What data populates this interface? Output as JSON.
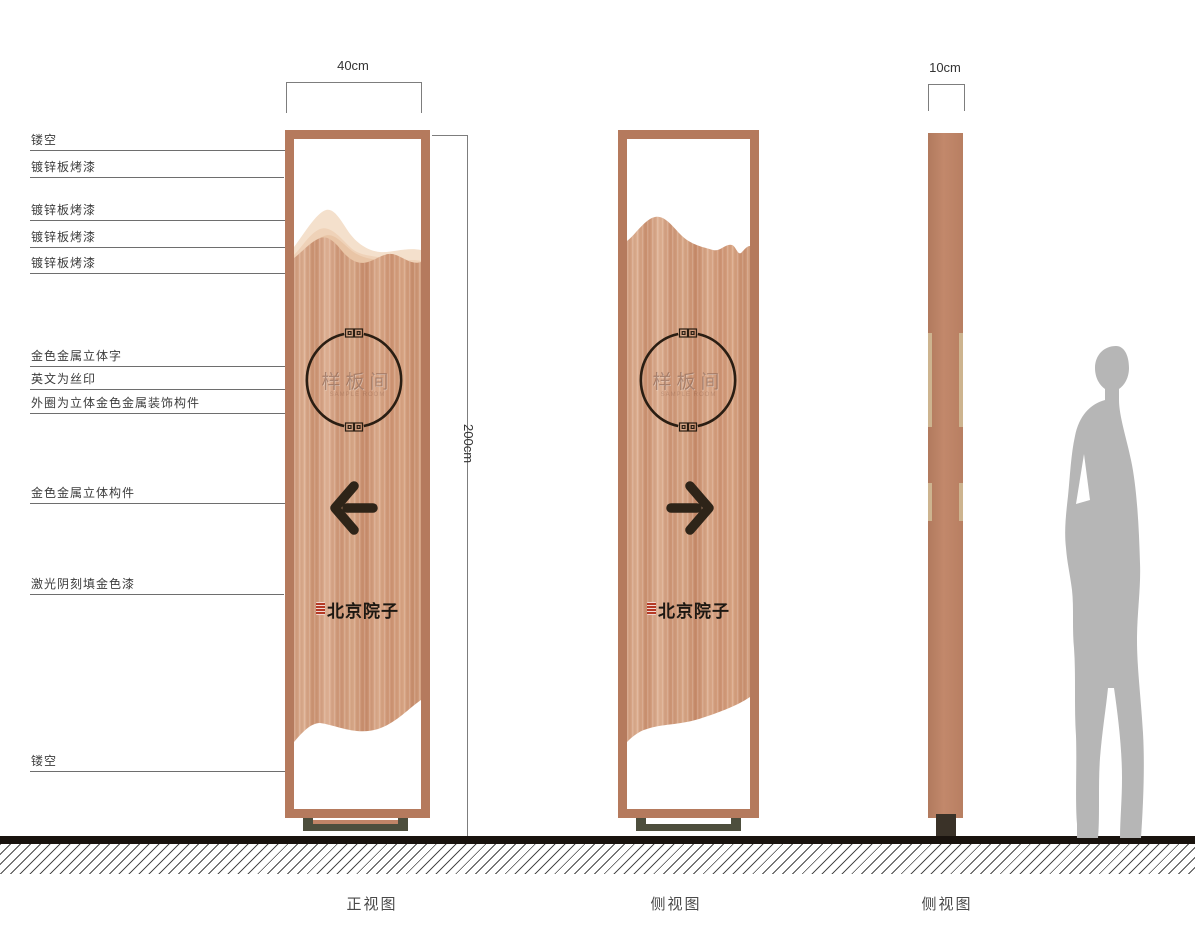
{
  "annotations": [
    {
      "label": "镂空"
    },
    {
      "label": "镀锌板烤漆"
    },
    {
      "label": "镀锌板烤漆"
    },
    {
      "label": "镀锌板烤漆"
    },
    {
      "label": "镀锌板烤漆"
    },
    {
      "label": "金色金属立体字"
    },
    {
      "label": "英文为丝印"
    },
    {
      "label": "外圈为立体金色金属装饰构件"
    },
    {
      "label": "金色金属立体构件"
    },
    {
      "label": "激光阴刻填金色漆"
    },
    {
      "label": "镂空"
    }
  ],
  "dimensions": {
    "front_width": "40cm",
    "height": "200cm",
    "side_width": "10cm"
  },
  "sign_front": {
    "circle_text": "样板间",
    "circle_subtext": "SAMPLE ROOM",
    "brand_text": "北京院子"
  },
  "sign_back": {
    "circle_text": "样板间",
    "circle_subtext": "SAMPLE ROOM",
    "brand_text": "北京院子"
  },
  "view_labels": [
    "正视图",
    "侧视图",
    "侧视图"
  ],
  "colors": {
    "frame": "#b57a5d",
    "panel": "#d3a081",
    "mountain_light": "#f4e0cc",
    "accent_dark": "#2e2418",
    "base_metal": "#4d4e3d",
    "seal_red": "#b43a25",
    "ground": "#19130e",
    "silhouette": "#b6b6b6"
  }
}
